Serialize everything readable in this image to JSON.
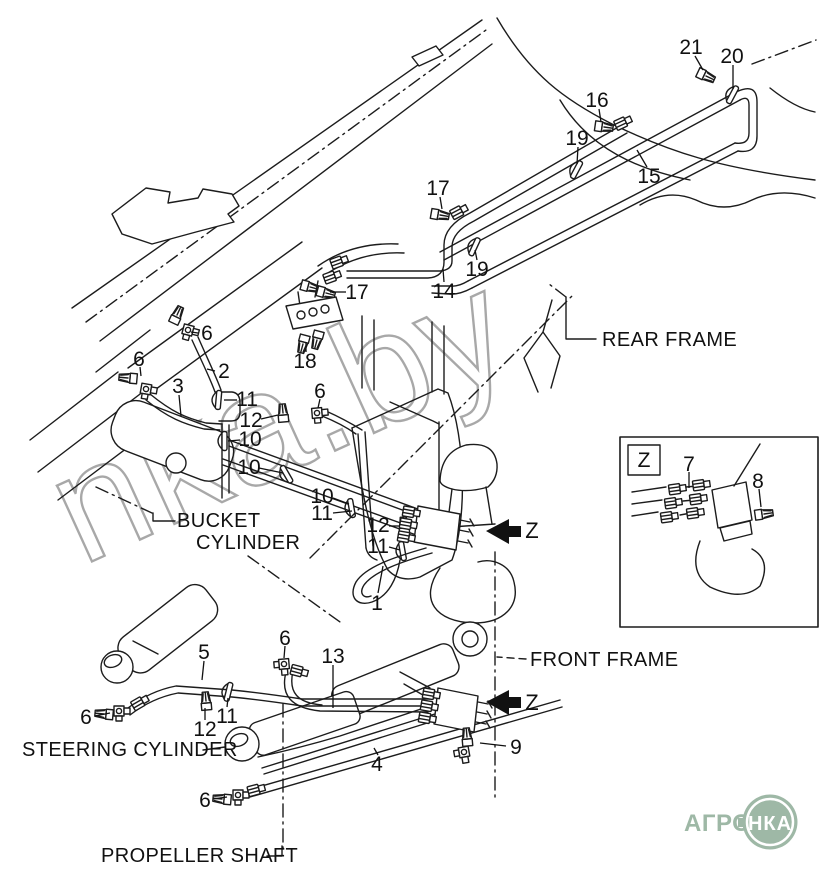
{
  "diagram": {
    "type": "hydraulic-piping-parts-diagram",
    "colors": {
      "line": "#1c1c1c",
      "watermark": "#a8a8a8",
      "logo_green": "#9eb8a6",
      "background": "#ffffff"
    },
    "watermark": {
      "text": "nka.by"
    },
    "labels": {
      "rear_frame": "REAR FRAME",
      "bucket_line1": "BUCKET",
      "bucket_line2": "CYLINDER",
      "front_frame": "FRONT FRAME",
      "steering_cylinder": "STEERING CYLINDER",
      "propeller_shaft": "PROPELLER SHAFT"
    },
    "detail_box": {
      "label": "Z"
    },
    "view_arrows": [
      {
        "label": "Z"
      },
      {
        "label": "Z"
      }
    ],
    "logo": {
      "text": "АГРО",
      "badge": "НКА"
    },
    "callouts": [
      {
        "n": "21",
        "x": 691,
        "y": 47,
        "leader": [
          [
            695,
            56
          ],
          [
            703,
            70
          ]
        ]
      },
      {
        "n": "20",
        "x": 732,
        "y": 56,
        "leader": [
          [
            733,
            65
          ],
          [
            733,
            89
          ]
        ]
      },
      {
        "n": "16",
        "x": 597,
        "y": 100,
        "leader": [
          [
            599,
            109
          ],
          [
            601,
            122
          ]
        ]
      },
      {
        "n": "19",
        "x": 577,
        "y": 138,
        "leader": [
          [
            578,
            147
          ],
          [
            577,
            164
          ]
        ]
      },
      {
        "n": "15",
        "x": 649,
        "y": 176,
        "leader": [
          [
            647,
            167
          ],
          [
            637,
            150
          ]
        ]
      },
      {
        "n": "17",
        "x": 438,
        "y": 188,
        "leader": [
          [
            440,
            197
          ],
          [
            442,
            209
          ]
        ]
      },
      {
        "n": "19",
        "x": 477,
        "y": 269,
        "leader": [
          [
            477,
            260
          ],
          [
            475,
            250
          ]
        ]
      },
      {
        "n": "14",
        "x": 444,
        "y": 291,
        "leader": [
          [
            444,
            282
          ],
          [
            443,
            269
          ]
        ]
      },
      {
        "n": "17",
        "x": 357,
        "y": 292,
        "leader": [
          [
            346,
            292
          ],
          [
            330,
            292
          ]
        ]
      },
      {
        "n": "18",
        "x": 305,
        "y": 361,
        "leader": [
          [
            306,
            352
          ],
          [
            306,
            342
          ]
        ]
      },
      {
        "n": "6",
        "x": 207,
        "y": 333,
        "leader": [
          [
            198,
            333
          ],
          [
            191,
            332
          ]
        ]
      },
      {
        "n": "6",
        "x": 139,
        "y": 359,
        "leader": [
          [
            140,
            367
          ],
          [
            141,
            376
          ]
        ]
      },
      {
        "n": "2",
        "x": 224,
        "y": 371,
        "leader": [
          [
            215,
            371
          ],
          [
            207,
            369
          ]
        ]
      },
      {
        "n": "3",
        "x": 178,
        "y": 386,
        "leader": [
          [
            179,
            395
          ],
          [
            181,
            416
          ]
        ]
      },
      {
        "n": "11",
        "x": 247,
        "y": 399,
        "leader": [
          [
            237,
            400
          ],
          [
            224,
            400
          ]
        ]
      },
      {
        "n": "12",
        "x": 251,
        "y": 420,
        "leader": [
          [
            261,
            419
          ],
          [
            278,
            415
          ]
        ]
      },
      {
        "n": "10",
        "x": 250,
        "y": 439,
        "leader": [
          [
            240,
            440
          ],
          [
            228,
            441
          ]
        ]
      },
      {
        "n": "10",
        "x": 249,
        "y": 467,
        "leader": [
          [
            259,
            468
          ],
          [
            283,
            473
          ]
        ]
      },
      {
        "n": "6",
        "x": 320,
        "y": 391,
        "leader": [
          [
            320,
            399
          ],
          [
            318,
            408
          ]
        ]
      },
      {
        "n": "10",
        "x": 322,
        "y": 496,
        "leader": [
          [
            333,
            498
          ],
          [
            349,
            504
          ]
        ]
      },
      {
        "n": "11",
        "x": 322,
        "y": 513,
        "leader": [
          [
            333,
            513
          ],
          [
            352,
            511
          ]
        ]
      },
      {
        "n": "12",
        "x": 378,
        "y": 525,
        "leader": [
          [
            389,
            526
          ],
          [
            400,
            526
          ]
        ]
      },
      {
        "n": "11",
        "x": 378,
        "y": 546,
        "leader": [
          [
            389,
            547
          ],
          [
            400,
            550
          ]
        ]
      },
      {
        "n": "1",
        "x": 377,
        "y": 603,
        "leader": [
          [
            378,
            593
          ],
          [
            383,
            566
          ]
        ]
      },
      {
        "n": "5",
        "x": 204,
        "y": 652,
        "leader": [
          [
            204,
            661
          ],
          [
            202,
            680
          ]
        ]
      },
      {
        "n": "6",
        "x": 285,
        "y": 638,
        "leader": [
          [
            285,
            646
          ],
          [
            284,
            658
          ]
        ]
      },
      {
        "n": "13",
        "x": 333,
        "y": 656,
        "leader": [
          [
            333,
            665
          ],
          [
            333,
            708
          ]
        ]
      },
      {
        "n": "6",
        "x": 86,
        "y": 717,
        "leader": [
          [
            95,
            716
          ],
          [
            110,
            713
          ]
        ]
      },
      {
        "n": "12",
        "x": 205,
        "y": 729,
        "leader": [
          [
            205,
            720
          ],
          [
            205,
            708
          ]
        ]
      },
      {
        "n": "11",
        "x": 227,
        "y": 716,
        "leader": [
          [
            227,
            707
          ],
          [
            228,
            698
          ]
        ]
      },
      {
        "n": "9",
        "x": 516,
        "y": 747,
        "leader": [
          [
            506,
            746
          ],
          [
            480,
            743
          ]
        ]
      },
      {
        "n": "4",
        "x": 377,
        "y": 764,
        "leader": [
          [
            378,
            755
          ],
          [
            374,
            748
          ]
        ]
      },
      {
        "n": "6",
        "x": 205,
        "y": 800,
        "leader": [
          [
            213,
            799
          ],
          [
            227,
            797
          ]
        ]
      },
      {
        "n": "7",
        "x": 689,
        "y": 464,
        "leader": [
          [
            689,
            472
          ],
          [
            689,
            488
          ]
        ]
      },
      {
        "n": "8",
        "x": 758,
        "y": 481,
        "leader": [
          [
            759,
            489
          ],
          [
            761,
            507
          ]
        ]
      }
    ]
  }
}
